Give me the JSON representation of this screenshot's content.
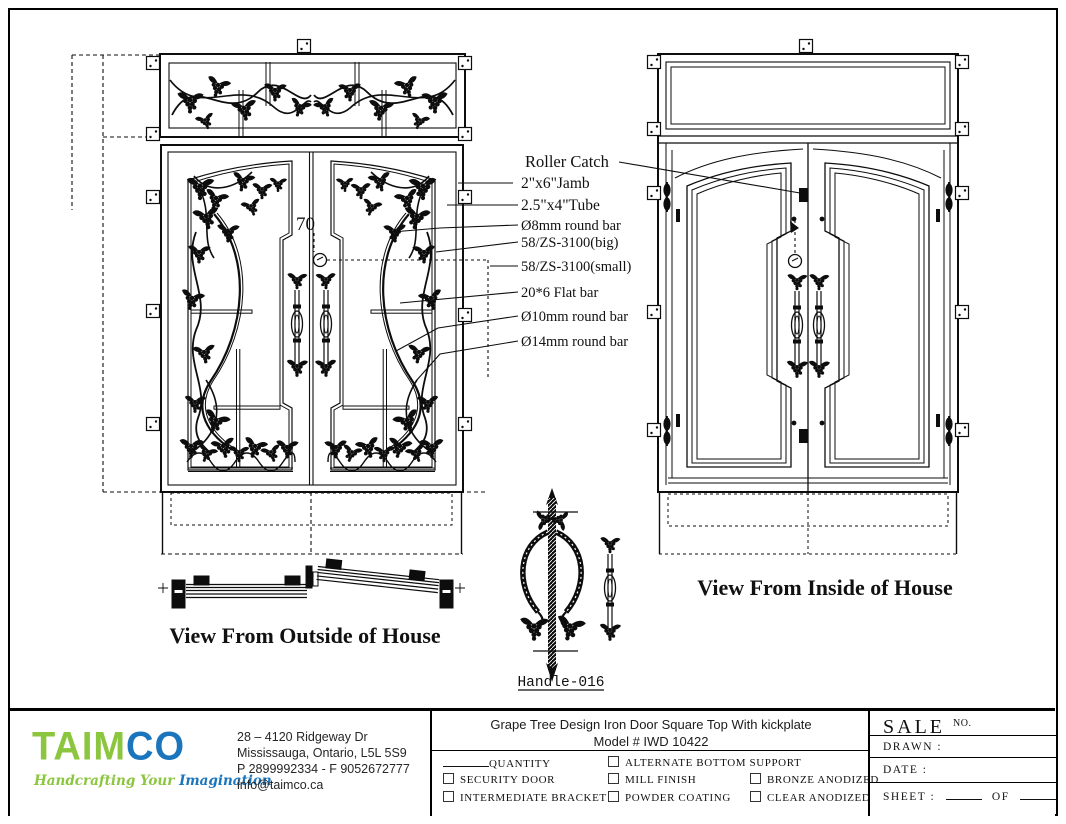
{
  "drawing": {
    "labels": {
      "outside_view": "View From Outside of House",
      "inside_view": "View From Inside of House",
      "handle_label": "Handle-016",
      "dimension_70": "70"
    },
    "callouts": [
      "Roller Catch",
      "2\"x6\"Jamb",
      "2.5\"x4\"Tube",
      "Ø8mm round bar",
      "58/ZS-3100(big)",
      "58/ZS-3100(small)",
      "20*6 Flat bar",
      "Ø10mm round bar",
      "Ø14mm round bar"
    ],
    "line_color": "#0d0d0d"
  },
  "title_block": {
    "company": {
      "logo_text_green": "TAIM",
      "logo_text_blue": "CO",
      "tagline_green": "Handcrafting Your ",
      "tagline_blue": "Imagination",
      "address_line1": "28 – 4120 Ridgeway Dr",
      "address_line2": "Mississauga, Ontario, L5L 5S9",
      "address_line3": "P 2899992334 - F 9052672777",
      "address_line4": "info@taimco.ca",
      "brand_green": "#8CC63F",
      "brand_blue": "#1B75BC"
    },
    "product": {
      "title": "Grape Tree Design Iron Door Square Top With kickplate",
      "model": "Model # IWD 10422"
    },
    "options": {
      "quantity_label": "QUANTITY",
      "checkboxes": [
        "SECURITY DOOR",
        "INTERMEDIATE BRACKET",
        "ALTERNATE BOTTOM SUPPORT",
        "MILL FINISH",
        "POWDER COATING",
        "BRONZE ANODIZED",
        "CLEAR ANODIZED"
      ]
    },
    "sale": {
      "sale_label": "SALE",
      "no_label": "NO.",
      "drawn_label": "DRAWN :",
      "date_label": "DATE :",
      "sheet_label": "SHEET :",
      "of_label": "OF"
    }
  }
}
